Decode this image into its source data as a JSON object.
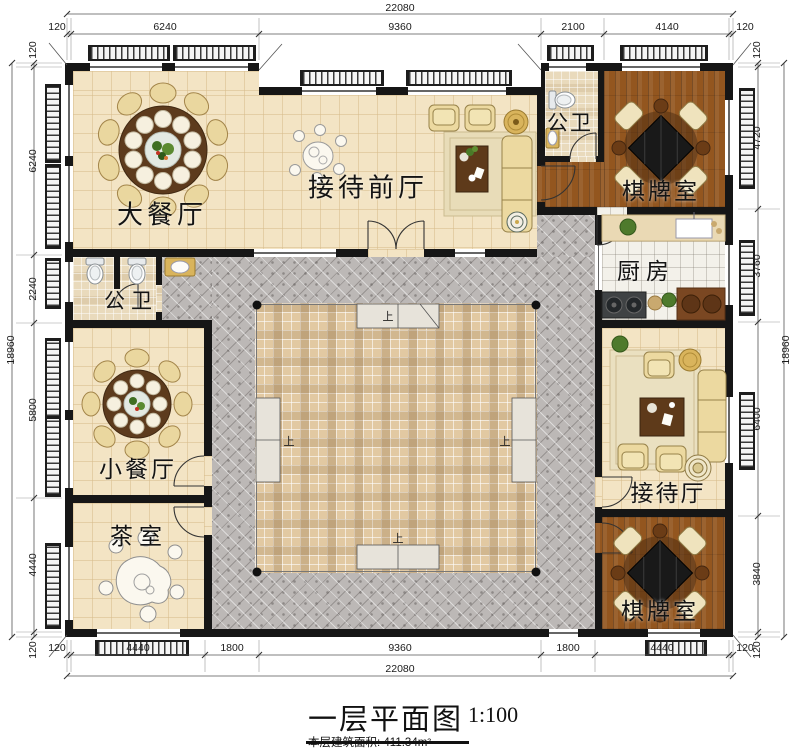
{
  "title_block": {
    "title": "一层平面图",
    "scale": "1:100",
    "area_note": "本层建筑面积: 411.34m²"
  },
  "rooms": {
    "grand_dining": "大餐厅",
    "front_reception": "接待前厅",
    "wc_top": "公卫",
    "chess_top": "棋牌室",
    "kitchen": "厨房",
    "wc_left": "公卫",
    "small_dining": "小餐厅",
    "tea_room": "茶室",
    "reception_hall": "接待厅",
    "chess_bottom": "棋牌室",
    "up": "上"
  },
  "dimensions": {
    "top_total": "22080",
    "bottom_total": "22080",
    "left_total": "18960",
    "right_total": "18960",
    "top": [
      "120",
      "6240",
      "9360",
      "2100",
      "4140",
      "120"
    ],
    "bottom": [
      "120",
      "4440",
      "1800",
      "9360",
      "1800",
      "4440",
      "120"
    ],
    "left": [
      "120",
      "6240",
      "2240",
      "5800",
      "4440",
      "120"
    ],
    "right": [
      "120",
      "4720",
      "3760",
      "6400",
      "3840",
      "120"
    ]
  },
  "colors": {
    "wall": "#161616",
    "floor_cream": "#f3e4c4",
    "floor_wood": "#93561f",
    "floor_corridor": "#bcb8b6",
    "courtyard": "#e2c9a2",
    "accent_gold": "#d9b45c"
  }
}
